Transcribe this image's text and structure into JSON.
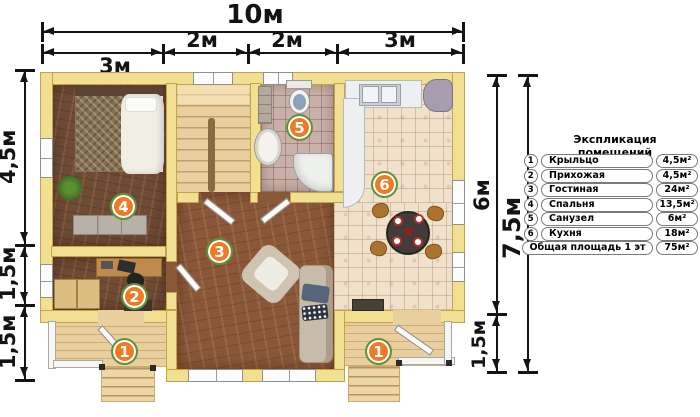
{
  "dims": {
    "top_total": "10м",
    "top_segments": [
      "3м",
      "2м",
      "2м",
      "3м"
    ],
    "left_segments": [
      "4,5м",
      "1,5м",
      "1,5м"
    ],
    "right_segments": [
      "6м",
      "1,5м"
    ],
    "right_total": "7,5м"
  },
  "legend": {
    "title": "Экспликация помещений",
    "rows": [
      {
        "num": "1",
        "name": "Крыльцо",
        "area": "4,5м²"
      },
      {
        "num": "2",
        "name": "Прихожая",
        "area": "4,5м²"
      },
      {
        "num": "3",
        "name": "Гостиная",
        "area": "24м²"
      },
      {
        "num": "4",
        "name": "Спальня",
        "area": "13,5м²"
      },
      {
        "num": "5",
        "name": "Санузел",
        "area": "6м²"
      },
      {
        "num": "6",
        "name": "Кухня",
        "area": "18м²"
      },
      {
        "num": "",
        "name": "Общая площадь 1 эт",
        "area": "75м²"
      }
    ]
  },
  "badges": {
    "porch_left": "1",
    "hallway": "2",
    "living": "3",
    "bedroom": "4",
    "bathroom": "5",
    "kitchen": "6",
    "porch_right": "1"
  },
  "colors": {
    "badge_fill": "#ee7b23",
    "badge_ring": "#61913c",
    "wall": "#f1e091",
    "wall_border": "#c3a44b",
    "dimension": "#141414"
  }
}
